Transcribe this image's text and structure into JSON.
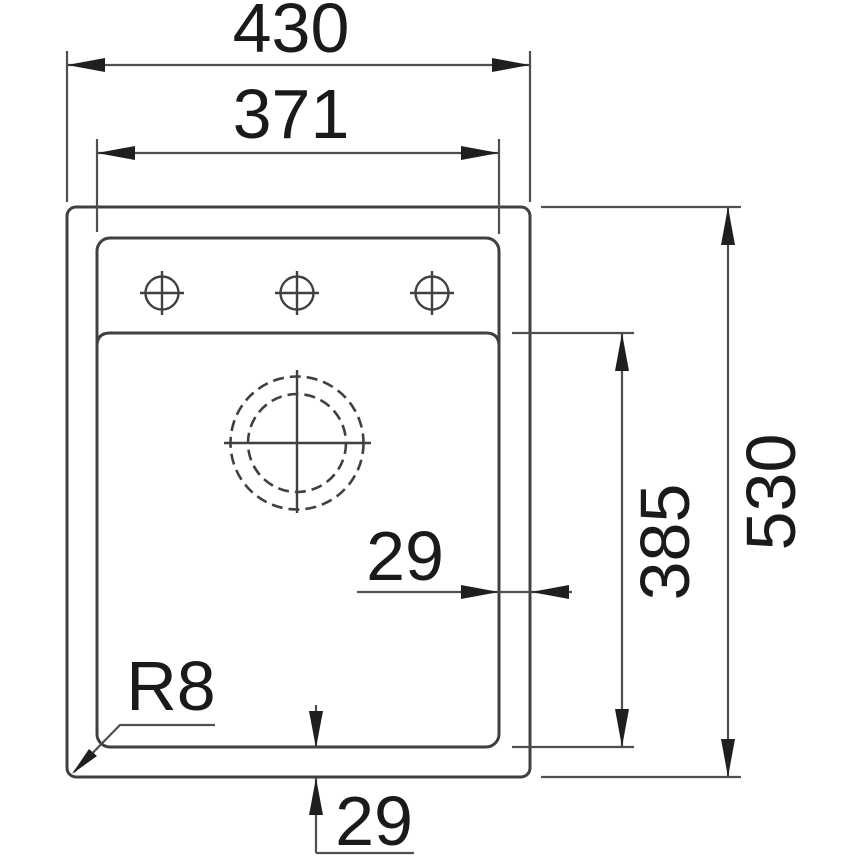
{
  "drawing": {
    "type": "technical-dimension-drawing",
    "subject": "kitchen sink top view"
  },
  "dimensions": {
    "overall_width": "430",
    "inner_width": "371",
    "overall_height": "530",
    "bowl_height": "385",
    "right_offset": "29",
    "bottom_offset": "29",
    "corner_radius": "R8"
  },
  "colors": {
    "background": "#ffffff",
    "outline": "#404040",
    "dimension_lines": "#4f4f4f",
    "arrows": "#1f1f1f",
    "text": "#1a1a1a"
  }
}
